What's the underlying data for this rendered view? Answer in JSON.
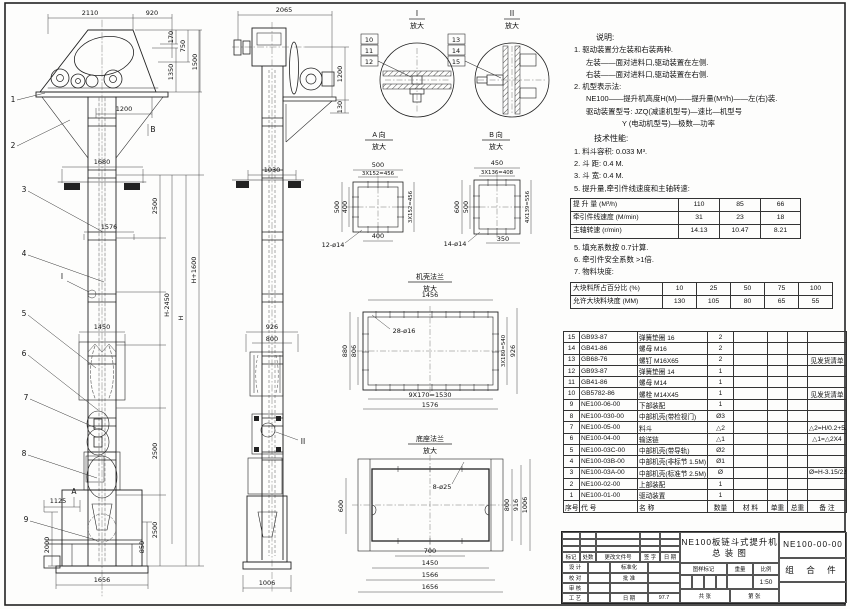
{
  "drawing": {
    "front": {
      "top1": "2110",
      "top2": "920",
      "h170": "170",
      "h750": "750",
      "h1350": "1350",
      "h1500": "1500",
      "w1200": "1200",
      "w1680": "1680",
      "w1576": "1576",
      "w1450": "1450",
      "v2500a": "2500",
      "v2500b": "2500",
      "v2500c": "2500",
      "hm": "H-2450",
      "hh": "H",
      "hp": "H+1600",
      "w1125": "1125",
      "v2000": "2000",
      "v850": "850",
      "w1656": "1656",
      "balloons": [
        "1",
        "2",
        "3",
        "4",
        "5",
        "6",
        "7",
        "8",
        "9"
      ],
      "va": "A",
      "vb": "B",
      "di": "I"
    },
    "side": {
      "top": "2065",
      "v1200": "1200",
      "v130": "130",
      "w1030": "1030",
      "w926": "926",
      "w800": "800",
      "w1006": "1006",
      "dii": "II"
    },
    "details": {
      "d1": {
        "no": "I",
        "mag": "放大",
        "c": [
          "10",
          "11",
          "12"
        ]
      },
      "d2": {
        "no": "II",
        "mag": "放大",
        "c": [
          "13",
          "14",
          "15"
        ]
      },
      "va": {
        "t": "A 向",
        "mag": "放大",
        "top": "500",
        "top2": "3X152=456",
        "left": "500",
        "left2": "400",
        "right": "3X152=456",
        "bot": "400",
        "callout": "12-ø14"
      },
      "vb": {
        "t": "B 向",
        "mag": "放大",
        "top": "450",
        "top2": "3X136=408",
        "left": "600",
        "left2": "500",
        "right": "4X139=556",
        "bot": "350",
        "callout": "14-ø14"
      },
      "fl": {
        "t": "机壳法兰",
        "mag": "放大",
        "top": "1456",
        "left": "880",
        "left2": "806",
        "right": "3X180=540",
        "right2": "926",
        "bot": "9X170=1530",
        "bot2": "1576",
        "callout": "28-ø16"
      },
      "bs": {
        "t": "底座法兰",
        "mag": "放大",
        "left": "600",
        "r1": "800",
        "r2": "916",
        "r3": "1006",
        "b1": "700",
        "b2": "1450",
        "b3": "1566",
        "b4": "1656",
        "callout": "8-ø25"
      }
    }
  },
  "notes": {
    "heading": "说明:",
    "lines": [
      "1. 驱动装置分左装和右装两种.",
      "左装——面对进料口,驱动装置在左侧.",
      "右装——面对进料口,驱动装置在右侧.",
      "2. 机型表示法:",
      "NE100——提升机高度H(M)——提升量(M³/h)——左(右)装.",
      "驱动装置型号: JZQ(减速机型号)—速比—机型号",
      "Y (电动机型号)—极数—功率"
    ]
  },
  "specs": {
    "heading": "技术性能:",
    "items": [
      "1. 料斗容积: 0.033 M³.",
      "2. 斗  距: 0.4 M.",
      "3. 斗  宽: 0.4 M.",
      "5. 提升量,牵引件线速度和主轴转速:"
    ],
    "table1": {
      "rows": [
        [
          "提 升 量 (M³/h)",
          "110",
          "85",
          "66"
        ],
        [
          "牵引件线速度 (M/min)",
          "31",
          "23",
          "18"
        ],
        [
          "主轴转速 (r/min)",
          "14.13",
          "10.47",
          "8.21"
        ]
      ]
    },
    "items2": [
      "5. 填充系数按 0.7计算.",
      "6. 牵引件安全系数 >1倍.",
      "7. 物料块度:"
    ],
    "table2": {
      "rows": [
        [
          "大块料所占百分比 (%)",
          "10",
          "25",
          "50",
          "75",
          "100"
        ],
        [
          "允许大块料块度 (MM)",
          "130",
          "105",
          "80",
          "65",
          "55"
        ]
      ]
    }
  },
  "parts": {
    "headers": [
      "序号",
      "代  号",
      "名  称",
      "数量",
      "材  料",
      "单重",
      "总重",
      "备 注"
    ],
    "rows": [
      [
        "15",
        "GB93-87",
        "弹簧垫圈 16",
        "2",
        "",
        "",
        "",
        ""
      ],
      [
        "14",
        "GB41-86",
        "螺母 M16",
        "2",
        "",
        "",
        "",
        ""
      ],
      [
        "13",
        "GB68-76",
        "螺钉 M16X65",
        "2",
        "",
        "",
        "",
        "见发货清单"
      ],
      [
        "12",
        "GB93-87",
        "弹簧垫圈 14",
        "1",
        "",
        "",
        "",
        ""
      ],
      [
        "11",
        "GB41-86",
        "螺母 M14",
        "1",
        "",
        "",
        "",
        ""
      ],
      [
        "10",
        "GB5782-86",
        "螺栓 M14X45",
        "1",
        "",
        "",
        "",
        "见发货清单"
      ],
      [
        "9",
        "NE100-06-00",
        "下部装配",
        "1",
        "",
        "",
        "",
        ""
      ],
      [
        "8",
        "NE100-030-00",
        "中部机壳(带检视门)",
        "Ø3",
        "",
        "",
        "",
        ""
      ],
      [
        "7",
        "NE100-05-00",
        "料斗",
        "△2",
        "",
        "",
        "",
        "△2=H/0.2+5.75"
      ],
      [
        "6",
        "NE100-04-00",
        "输送链",
        "△1",
        "",
        "",
        "",
        "△1=△2X4"
      ],
      [
        "5",
        "NE100-03C-00",
        "中部机壳(带导轨)",
        "Ø2",
        "",
        "",
        "",
        ""
      ],
      [
        "4",
        "NE100-03B-00",
        "中部机壳(非标节 1.5M)",
        "Ø1",
        "",
        "",
        "",
        ""
      ],
      [
        "3",
        "NE100-03A-00",
        "中部机壳(标准节 2.5M)",
        "Ø",
        "",
        "",
        "",
        "Ø=H-3.15/2.5"
      ],
      [
        "2",
        "NE100-02-00",
        "上部装配",
        "1",
        "",
        "",
        "",
        ""
      ],
      [
        "1",
        "NE100-01-00",
        "驱动装置",
        "1",
        "",
        "",
        "",
        ""
      ]
    ]
  },
  "titleblock": {
    "rev_row": [
      "标记",
      "处数",
      "更改文件号",
      "签 字",
      "日 期"
    ],
    "r1a": "设 计",
    "r1b": "标准化",
    "r2a": "校 对",
    "r2b": "批 准",
    "r3a": "审 核",
    "r3b": "",
    "r4a": "工 艺",
    "r4b": "日 期",
    "date": "97.7",
    "title_line1": "NE100板链斗式提升机",
    "title_line2": "总  装  图",
    "mark_h1": "图样标记",
    "mark_h2": "重量",
    "mark_h3": "比例",
    "scale": "1:50",
    "sheet1": "共  张",
    "sheet2": "第  张",
    "drawing_no": "NE100-00-00",
    "part_type": "组 合 件"
  }
}
